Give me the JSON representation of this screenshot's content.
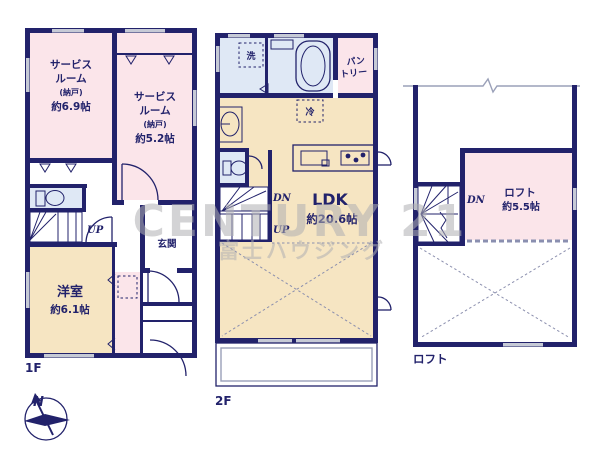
{
  "watermark": {
    "brand": "CENTURY 21",
    "company": "富士ハウジング"
  },
  "compass": {
    "north": "N"
  },
  "colors": {
    "wall_navy": "#22226b",
    "room_pink": "#fbe5ea",
    "room_beige": "#f6e5c2",
    "room_blue": "#dfe8f5",
    "window_gray": "#c6cad6",
    "watermark_gray": "#b0b0b3"
  },
  "floors": {
    "f1": {
      "label": "1F",
      "service_room_1": {
        "line1": "サービス",
        "line2": "ルーム",
        "line3": "(納戸)",
        "size": "約6.9帖"
      },
      "service_room_2": {
        "line1": "サービス",
        "line2": "ルーム",
        "line3": "(納戸)",
        "size": "約5.2帖"
      },
      "western_room": {
        "name": "洋室",
        "size": "約6.1帖"
      },
      "entrance": {
        "name": "玄関"
      },
      "stairs_up": "UP"
    },
    "f2": {
      "label": "2F",
      "ldk": {
        "name": "LDK",
        "size": "約20.6帖"
      },
      "pantry": {
        "line1": "パン",
        "line2": "トリー"
      },
      "laundry": "洗",
      "fridge": "冷",
      "stairs_dn": "DN",
      "stairs_up": "UP"
    },
    "loft": {
      "label": "ロフト",
      "loft_room": {
        "name": "ロフト",
        "size": "約5.5帖"
      },
      "stairs_dn": "DN"
    }
  }
}
